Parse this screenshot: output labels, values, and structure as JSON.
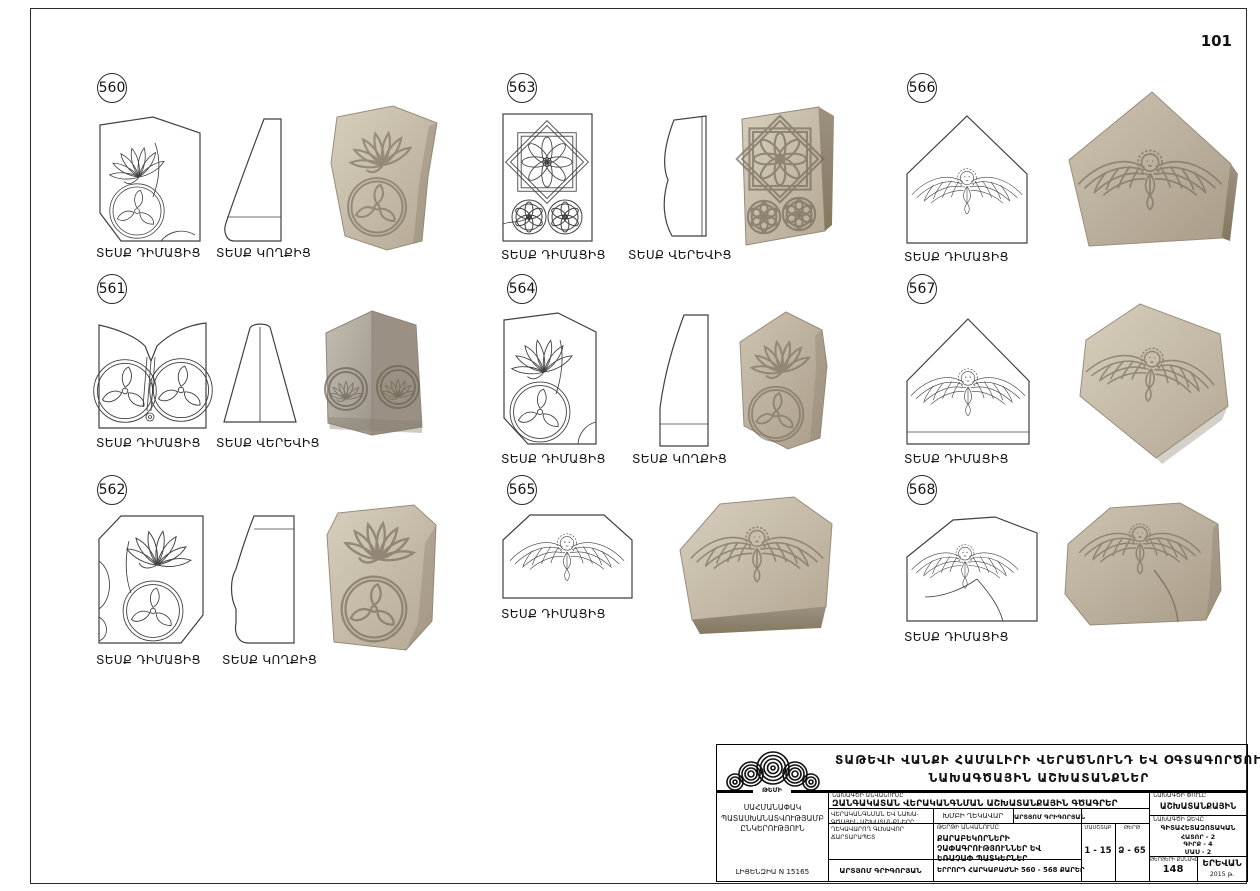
{
  "page_number": "101",
  "items": [
    {
      "num": "560",
      "view1": "ՏԵՍՔ ԴԻՄԱՑԻՑ",
      "view2": "ՏԵՍՔ ԿՈՂՔԻՑ"
    },
    {
      "num": "561",
      "view1": "ՏԵՍՔ ԴԻՄԱՑԻՑ",
      "view2": "ՏԵՍՔ ՎԵՐԵՎԻՑ"
    },
    {
      "num": "562",
      "view1": "ՏԵՍՔ ԴԻՄԱՑԻՑ",
      "view2": "ՏԵՍՔ ԿՈՂՔԻՑ"
    },
    {
      "num": "563",
      "view1": "ՏԵՍՔ ԴԻՄԱՑԻՑ",
      "view2": "ՏԵՍՔ ՎԵՐԵՎԻՑ"
    },
    {
      "num": "564",
      "view1": "ՏԵՍՔ ԴԻՄԱՑԻՑ",
      "view2": "ՏԵՍՔ ԿՈՂՔԻՑ"
    },
    {
      "num": "565",
      "view1": "ՏԵՍՔ ԴԻՄԱՑԻՑ"
    },
    {
      "num": "566",
      "view1": "ՏԵՍՔ ԴԻՄԱՑԻՑ"
    },
    {
      "num": "567",
      "view1": "ՏԵՍՔ ԴԻՄԱՑԻՑ"
    },
    {
      "num": "568",
      "view1": "ՏԵՍՔ ԴԻՄԱՑԻՑ"
    }
  ],
  "titleblock": {
    "logo_text": "ԹԵՄԻ",
    "title_line1": "ՏԱԹԵՎԻ ՎԱՆՔԻ ՀԱՄԱԼԻՐԻ ՎԵՐԱԾՆՈՒՆԴ ԵՎ ՕԳՏԱԳՈՐԾՈՒՄ",
    "title_line2": "ՆԱԽԱԳԾԱՅԻՆ ԱՇԽԱՏԱՆՔՆԵՐ",
    "company": "ՍԱՀՄԱՆԱՓԱԿ ՊԱՏԱՍԽԱՆԱՏՎՈՒԹՅԱՄԲ ԸՆԿԵՐՈՒԹՅՈՒՆ",
    "license": "ԼԻՑԵՆԶԻԱ N 15165",
    "project_label": "ՆԱԽԱԳԾԻ ԱՆՎԱՆՈՒՄԸ",
    "project_name": "ԶԱՆԳԱԿԱՏԱՆ ՎԵՐԱԿԱՆԳՆՄԱՆ ԱՇԽԱՏԱՆՔԱՅԻՆ ԳԾԱԳՐԵՐ",
    "chief_role": "ՎԵՐԱԿԱՆԳՆՄԱՆ ԵՎ ՆԱԽԱ­ԳԾԱՅԻՆ ԱՇԽԱՏԱՆՔՆԵՐԸ ՂԵԿԱՎԱՐՈՂ ԳԼԽԱՎՈՐ ՃԱՐՏԱՐԱՊԵՏ",
    "group_lead_label": "ԽՄԲԻ ՂԵԿԱՎԱՐ",
    "group_lead_name": "ԱՐՏՅՈՄ ԳՐԻԳՈՐՅԱՆ",
    "sheet_label": "ԹԵՐԹԻ ԱՆՎԱՆՈՒՄԸ",
    "sheet_name": "ՔԱՐԱԲԵԿՈՐՆԵՐԻ ՉԱՓԱԳՐՈՒԹՅՈՒՆՆԵՐ ԵՎ ԵՌԱՉԱՓ ՊԱՏԿԵՐՆԵՐ",
    "sheet_subtitle": "ԵՐՐՈՐԴ ՀԱՐԿԱԲԱԺՆԻ 560 - 568 ՔԱՐԵՐ",
    "architect_name": "ԱՐՏՅՈՄ ԳՐԻԳՈՐՅԱՆ",
    "scale_label": "ՄԱՍՇՏԱԲ",
    "scale_value": "1 - 15",
    "format_label": "ԹԵՐԹ",
    "format_value": "Ձ - 65",
    "phase_label": "ՆԱԽԱԳԾԻ ՓՈՒԼԸ",
    "phase_value": "ԱՇԽԱՏԱՆՔԱՅԻՆ",
    "type_label": "ՆԱԽԱԳԾԻ ՁԵՎԸ",
    "type_line1": "ԳԻՏԱՀԵՏԱԶՈՏԱԿԱՆ",
    "type_line2": "ՀԱՏՈՐ - 2",
    "type_line3": "ԳԻՐՔ - 4",
    "type_line4": "ՄԱՍ - 2",
    "sheets_label": "ԹԵՐԹԵՐԻ ՔԱՆԱԿԸ",
    "sheets_value": "148",
    "city": "ԵՐԵՎԱՆ",
    "year": "2015 թ."
  }
}
